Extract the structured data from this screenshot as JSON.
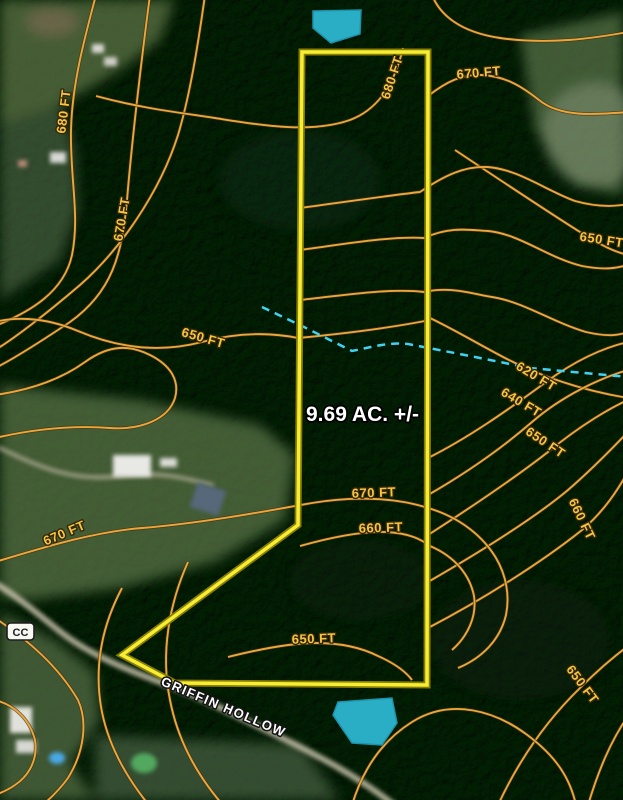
{
  "map": {
    "acreage": {
      "text": "9.69 AC. +/-",
      "x": 306,
      "y": 421
    },
    "road": {
      "text": "GRIFFIN HOLLOW",
      "x": 222,
      "y": 711,
      "rot": 23
    },
    "route_badge": {
      "text": "CC",
      "x": 7,
      "y": 623
    },
    "contour_labels": [
      {
        "text": "680 FT",
        "x": 68,
        "y": 112,
        "rot": -83
      },
      {
        "text": "670 FT",
        "x": 126,
        "y": 220,
        "rot": -80
      },
      {
        "text": "680 FT",
        "x": 396,
        "y": 79,
        "rot": -72
      },
      {
        "text": "670 FT",
        "x": 479,
        "y": 77,
        "rot": -5
      },
      {
        "text": "650 FT",
        "x": 601,
        "y": 244,
        "rot": 9
      },
      {
        "text": "650 FT",
        "x": 202,
        "y": 342,
        "rot": 16
      },
      {
        "text": "620 FT",
        "x": 534,
        "y": 380,
        "rot": 31
      },
      {
        "text": "640 FT",
        "x": 519,
        "y": 406,
        "rot": 31
      },
      {
        "text": "650 FT",
        "x": 543,
        "y": 446,
        "rot": 34
      },
      {
        "text": "660 FT",
        "x": 578,
        "y": 521,
        "rot": 64
      },
      {
        "text": "670 FT",
        "x": 66,
        "y": 537,
        "rot": -23
      },
      {
        "text": "670 FT",
        "x": 374,
        "y": 497,
        "rot": -2
      },
      {
        "text": "660 FT",
        "x": 381,
        "y": 532,
        "rot": -2
      },
      {
        "text": "650 FT",
        "x": 314,
        "y": 643,
        "rot": -2
      },
      {
        "text": "650 FT",
        "x": 579,
        "y": 687,
        "rot": 53
      }
    ],
    "colors": {
      "contour": "#eda63e",
      "contour_casing": "#42330c",
      "boundary": "#f6ee33",
      "boundary_casing": "#8a7c07",
      "stream": "#3fd2f2",
      "pond_fill": "#2aaec6",
      "pond_edge": "#1b93ab",
      "label_fill": "#f8c63c",
      "label_stroke": "#33270a",
      "acreage_fill": "#ffffff",
      "acreage_stroke": "#000000",
      "road_label_fill": "#ffffff",
      "road_label_stroke": "#141414",
      "badge_fill": "#f8f8f2",
      "badge_stroke": "#1e1e1e"
    }
  }
}
